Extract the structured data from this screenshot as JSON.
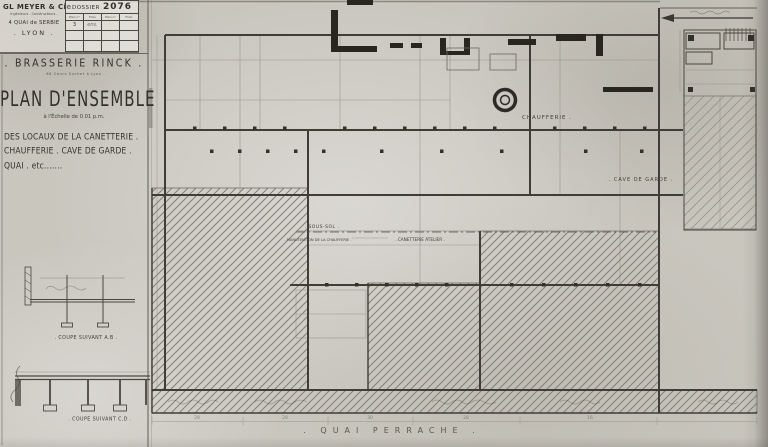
{
  "sheet": {
    "company": {
      "name": "GL MEYER & Cie",
      "subtitle": "Ingénieurs - Constructeurs .",
      "address": "4 QUAI de SERBIE",
      "city": ". LYON ."
    },
    "dossier": {
      "label": "DOSSIER",
      "number": "2076",
      "columns": [
        "Plan n°",
        "Folio",
        "Plan n°",
        "Folio"
      ],
      "rows": [
        [
          "3",
          "ens.",
          "",
          ""
        ],
        [
          "",
          "",
          "",
          ""
        ],
        [
          "",
          "",
          "",
          ""
        ]
      ]
    },
    "title": {
      "project": ". BRASSERIE  RINCK .",
      "project_sub": ". 66 Cours Suchet à Lyon .",
      "main": "PLAN D'ENSEMBLE",
      "scale": "à l'Échelle de 0.01 p.m.",
      "subject1": "DES LOCAUX DE LA CANETTERIE .",
      "subject2": "CHAUFFERIE . CAVE DE GARDE .",
      "subject3": "QUAI . etc......."
    },
    "sections": {
      "coupe_ab": ". COUPE SUIVANT A.B .",
      "coupe_cd": ". COUPE SUIVANT C.D ."
    },
    "plan": {
      "rooms": {
        "chaufferie": "CHAUFFERIE .",
        "cave_de_garde": ". CAVE DE GARDE .",
        "sous_sol": ". SOUS-SOL .",
        "manutention": ". MANUTENTION DE LA CHAUFFERIE .",
        "canetterie": ". CANETTERIE  ATELIER ."
      },
      "street": ". QUAI    PERRACHE .",
      "dimensions": [
        "28",
        "28",
        "30",
        "28",
        "16"
      ]
    },
    "colors": {
      "paper": "#c9c6be",
      "ink": "#35332e",
      "ink_faint": "#8d8a80",
      "hatch": "#85827a"
    }
  }
}
